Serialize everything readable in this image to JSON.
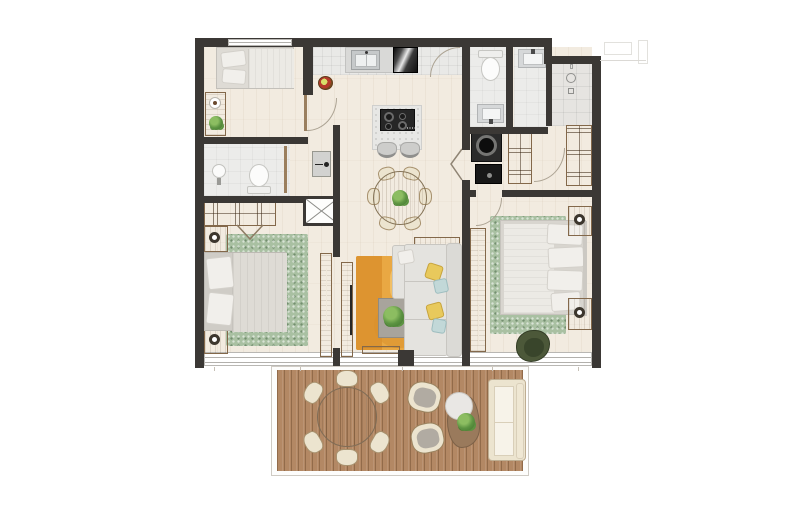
{
  "meta": {
    "kind": "2-bedroom apartment floor plan, top-down architectural render with furnished terrace",
    "canvas": {
      "width": 800,
      "height": 518
    },
    "visible_text": "none"
  },
  "palette": {
    "wall": "#3b3835",
    "floor": "#f2ebe0",
    "tile": "#e9e9e7",
    "tileEntry": "#e6e4e1",
    "bathTile": "#ececea",
    "deck": "#b38864",
    "rugGreen": "#a9c0a2",
    "rugOrange": "#e9a843",
    "rugOrangeDark": "#d98f2c",
    "rugOrangeLight": "#f2c169",
    "sofa": "#e4e3df",
    "sofaEdge": "#c8c6c1",
    "bedWhite": "#eceae5",
    "bedGray": "#dedbd5",
    "pillow": "#f1efeb",
    "wood": "#b0947"
  },
  "palette2_note": "palette continues",
  "palette2": {},
  "rooms": [
    {
      "id": "bedroom-small",
      "desc": "small bedroom top-left with bed, wall desk, plant"
    },
    {
      "id": "bathroom-main",
      "desc": "bathroom left with toilet and pedestal sink"
    },
    {
      "id": "kitchen",
      "desc": "kitchen with sink counter, fridge, island cooktop, two stools"
    },
    {
      "id": "dining",
      "desc": "round dining table, six chairs, centerpiece plant"
    },
    {
      "id": "bathroom-2",
      "desc": "bathroom top-right with toilet and vanity"
    },
    {
      "id": "shower-room",
      "desc": "shower room with vanity"
    },
    {
      "id": "entry-hall",
      "desc": "tiled entry with door swing"
    },
    {
      "id": "laundry",
      "desc": "laundry closet with washer and appliance, bifold door"
    },
    {
      "id": "wardrobes",
      "desc": "built-in closets in hallway"
    },
    {
      "id": "bedroom-main",
      "desc": "main bedroom bottom-left, bed on green rug, two nightstands, wardrobe"
    },
    {
      "id": "living",
      "desc": "living room with L-sofa, orange rug, coffee table, TV console"
    },
    {
      "id": "bedroom-2",
      "desc": "bedroom right, bed on green rug, nightstands, olive chair, sliding wardrobe"
    },
    {
      "id": "duct-shaft",
      "desc": "service shaft marked with X"
    },
    {
      "id": "terrace",
      "desc": "wood deck terrace: round table with six chairs, two armchairs, kidney side table with plant, outdoor sofa"
    }
  ]
}
